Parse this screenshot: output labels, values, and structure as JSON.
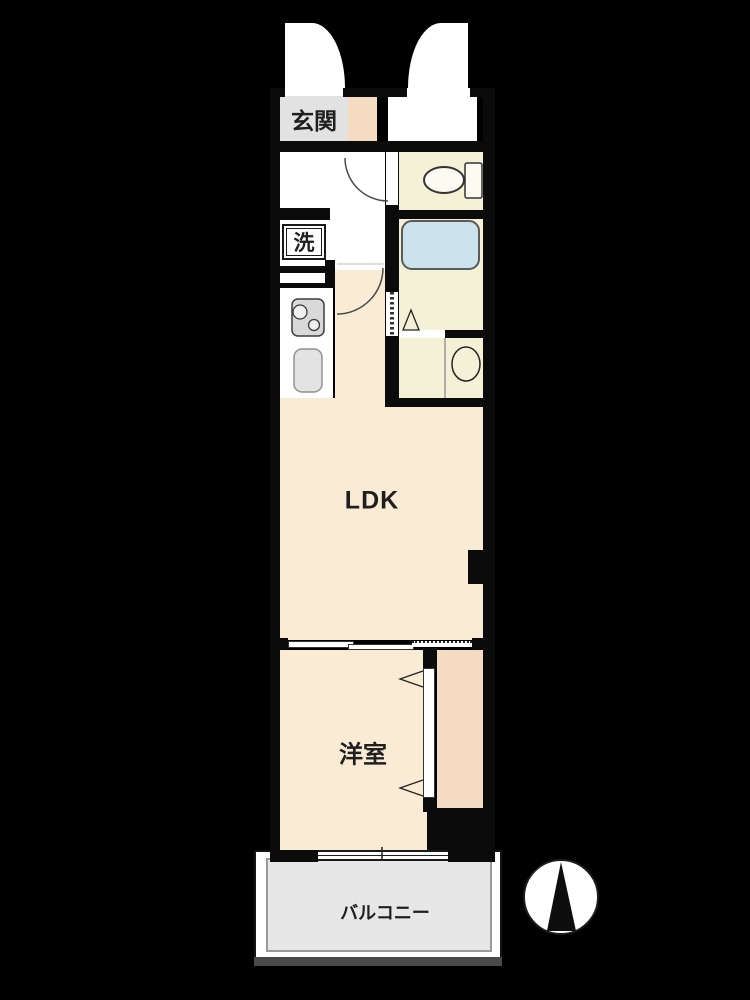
{
  "title": "apartment-floor-plan",
  "rooms": {
    "genkan": {
      "label": "玄関"
    },
    "laundry": {
      "label": "洗"
    },
    "ldk": {
      "label": "LDK"
    },
    "bedroom": {
      "label": "洋室"
    },
    "balcony": {
      "label": "バルコニー"
    }
  },
  "fixtures": [
    "entrance-doors",
    "toilet",
    "bathtub",
    "stove",
    "kitchen-sink",
    "washbasin",
    "washing-machine-space",
    "folding-door",
    "sliding-door",
    "closet",
    "window",
    "pillar"
  ],
  "compass": {
    "needle_points": "up"
  },
  "colors": {
    "background": "#000000",
    "floor_cream": "#faecd4",
    "floor_peach": "#f5dbc1",
    "floor_pale_yellow": "#f4f1d6",
    "genkan_gray": "#e2e2e2",
    "balcony_gray": "#e7e7e7",
    "bathtub_blue": "#cce2ed",
    "wall_black": "#0b0b0b"
  }
}
